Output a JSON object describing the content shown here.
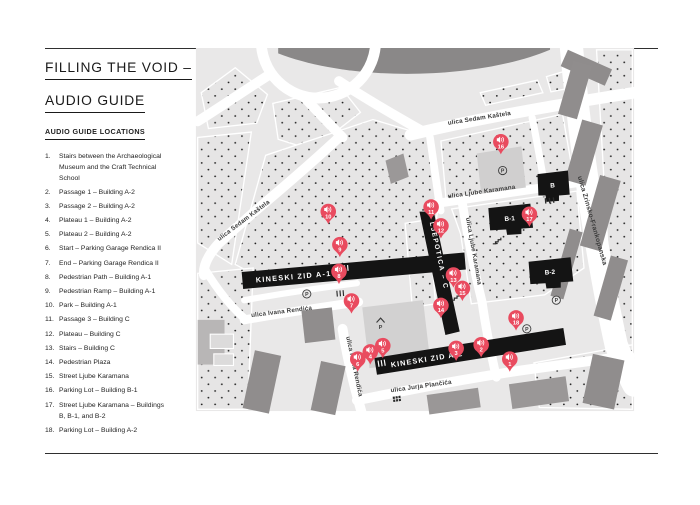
{
  "header": {
    "title_line1": "FILLING THE VOID –",
    "title_line2": "AUDIO GUIDE"
  },
  "sidebar": {
    "heading": "AUDIO GUIDE LOCATIONS",
    "items": [
      {
        "num": "1.",
        "label": "Stairs between the Archaeological Museum and the Craft Technical School"
      },
      {
        "num": "2.",
        "label": "Passage 1 – Building A-2"
      },
      {
        "num": "3.",
        "label": "Passage 2 – Building A-2"
      },
      {
        "num": "4.",
        "label": "Plateau 1 – Building A-2"
      },
      {
        "num": "5.",
        "label": "Plateau 2 – Building A-2"
      },
      {
        "num": "6.",
        "label": "Start – Parking Garage Rendica II"
      },
      {
        "num": "7.",
        "label": "End – Parking Garage Rendica II"
      },
      {
        "num": "8.",
        "label": "Pedestrian Path – Building A-1"
      },
      {
        "num": "9.",
        "label": "Pedestrian Ramp – Building A-1"
      },
      {
        "num": "10.",
        "label": "Park – Building A-1"
      },
      {
        "num": "11.",
        "label": "Passage 3 – Building C"
      },
      {
        "num": "12.",
        "label": "Plateau – Building C"
      },
      {
        "num": "13.",
        "label": "Stairs – Building C"
      },
      {
        "num": "14.",
        "label": "Pedestrian Plaza"
      },
      {
        "num": "15.",
        "label": "Street Ljube Karamana"
      },
      {
        "num": "16.",
        "label": "Parking Lot – Building B-1"
      },
      {
        "num": "17.",
        "label": "Street Ljube Karamana – Buildings B, B-1, and B-2"
      },
      {
        "num": "18.",
        "label": "Parking Lot – Building A-2"
      }
    ]
  },
  "map": {
    "street_labels": [
      {
        "id": "sedam-kastela-top",
        "text": "ulica Sedam Kaštela"
      },
      {
        "id": "sedam-kastela-left",
        "text": "ulica Sedam Kaštela"
      },
      {
        "id": "ljube-karamana-h",
        "text": "ulica Ljube Karamana"
      },
      {
        "id": "ljube-karamana-v",
        "text": "ulica Ljube Karamana"
      },
      {
        "id": "zrinsko-frankopanska",
        "text": "ulica Zrinsko-Frankopanska"
      },
      {
        "id": "ivana-rendica-h",
        "text": "ulica Ivana Rendića"
      },
      {
        "id": "ivana-rendica-v",
        "text": "ulica Ivana Rendića"
      },
      {
        "id": "jurja-plancica",
        "text": "ulica Jurja Plančića"
      }
    ],
    "bars": [
      {
        "id": "kineski-zid-a1",
        "label": "KINESKI ZID A-1"
      },
      {
        "id": "kineski-zid-a2",
        "label": "KINESKI ZID A-2"
      },
      {
        "id": "ljepotica-c",
        "label": "LJEPOTICA – C"
      }
    ],
    "buildings": [
      {
        "id": "b",
        "label": "B"
      },
      {
        "id": "b1",
        "label": "B-1"
      },
      {
        "id": "b2",
        "label": "B-2"
      }
    ],
    "parking_symbol": "P",
    "pins": [
      {
        "num": "1"
      },
      {
        "num": "2"
      },
      {
        "num": "3"
      },
      {
        "num": "4"
      },
      {
        "num": "5"
      },
      {
        "num": "6"
      },
      {
        "num": "7"
      },
      {
        "num": "8"
      },
      {
        "num": "9"
      },
      {
        "num": "10"
      },
      {
        "num": "11"
      },
      {
        "num": "12"
      },
      {
        "num": "13"
      },
      {
        "num": "14"
      },
      {
        "num": "15"
      },
      {
        "num": "16"
      },
      {
        "num": "17"
      },
      {
        "num": "18"
      }
    ]
  },
  "colors": {
    "pin": "#E94B5F",
    "black": "#141414",
    "map_bg": "#E9E8E8",
    "building_gray": "#908D8D",
    "building_light": "#D2D1D1",
    "road": "#FFFFFF",
    "street_text": "#3B3B3B"
  }
}
